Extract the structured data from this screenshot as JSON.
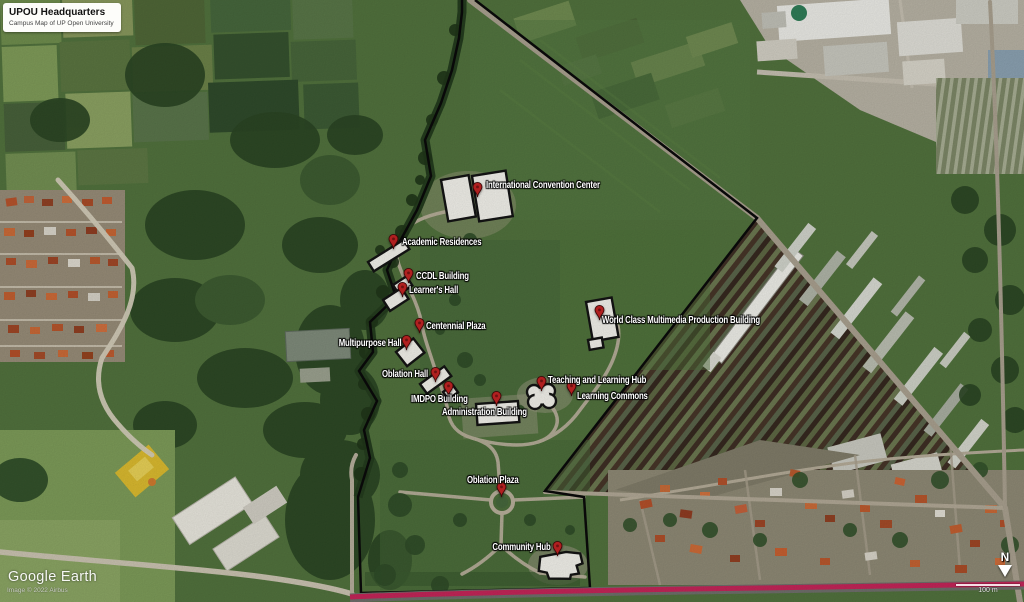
{
  "title_card": {
    "title": "UPOU Headquarters",
    "subtitle": "Campus Map of UP Open University"
  },
  "placemarks": [
    {
      "id": "international-convention-center",
      "label": "International Convention Center"
    },
    {
      "id": "academic-residences",
      "label": "Academic Residences"
    },
    {
      "id": "ccdl-building",
      "label": "CCDL Building"
    },
    {
      "id": "learners-hall",
      "label": "Learner's Hall"
    },
    {
      "id": "centennial-plaza",
      "label": "Centennial Plaza"
    },
    {
      "id": "multipurpose-hall",
      "label": "Multipurpose Hall"
    },
    {
      "id": "oblation-hall",
      "label": "Oblation Hall"
    },
    {
      "id": "imdpo-building",
      "label": "IMDPO Building"
    },
    {
      "id": "administration-building",
      "label": "Administration Building"
    },
    {
      "id": "teaching-and-learning-hub",
      "label": "Teaching and Learning Hub"
    },
    {
      "id": "learning-commons",
      "label": "Learning Commons"
    },
    {
      "id": "world-class-multimedia-production-building",
      "label": "World Class Multimedia Production Building"
    },
    {
      "id": "oblation-plaza",
      "label": "Oblation Plaza"
    },
    {
      "id": "community-hub",
      "label": "Community Hub"
    }
  ],
  "watermark": {
    "brand": "Google Earth",
    "attribution": "Image © 2022 Airbus"
  },
  "compass": {
    "north_label": "N"
  },
  "scale_bar": {
    "label": "100 m"
  },
  "colors": {
    "pin": "#b02020",
    "boundary": "#0a0a0a",
    "highlight_road": "#c22558",
    "label_text": "#ffffff",
    "field_green": "#51713d"
  }
}
